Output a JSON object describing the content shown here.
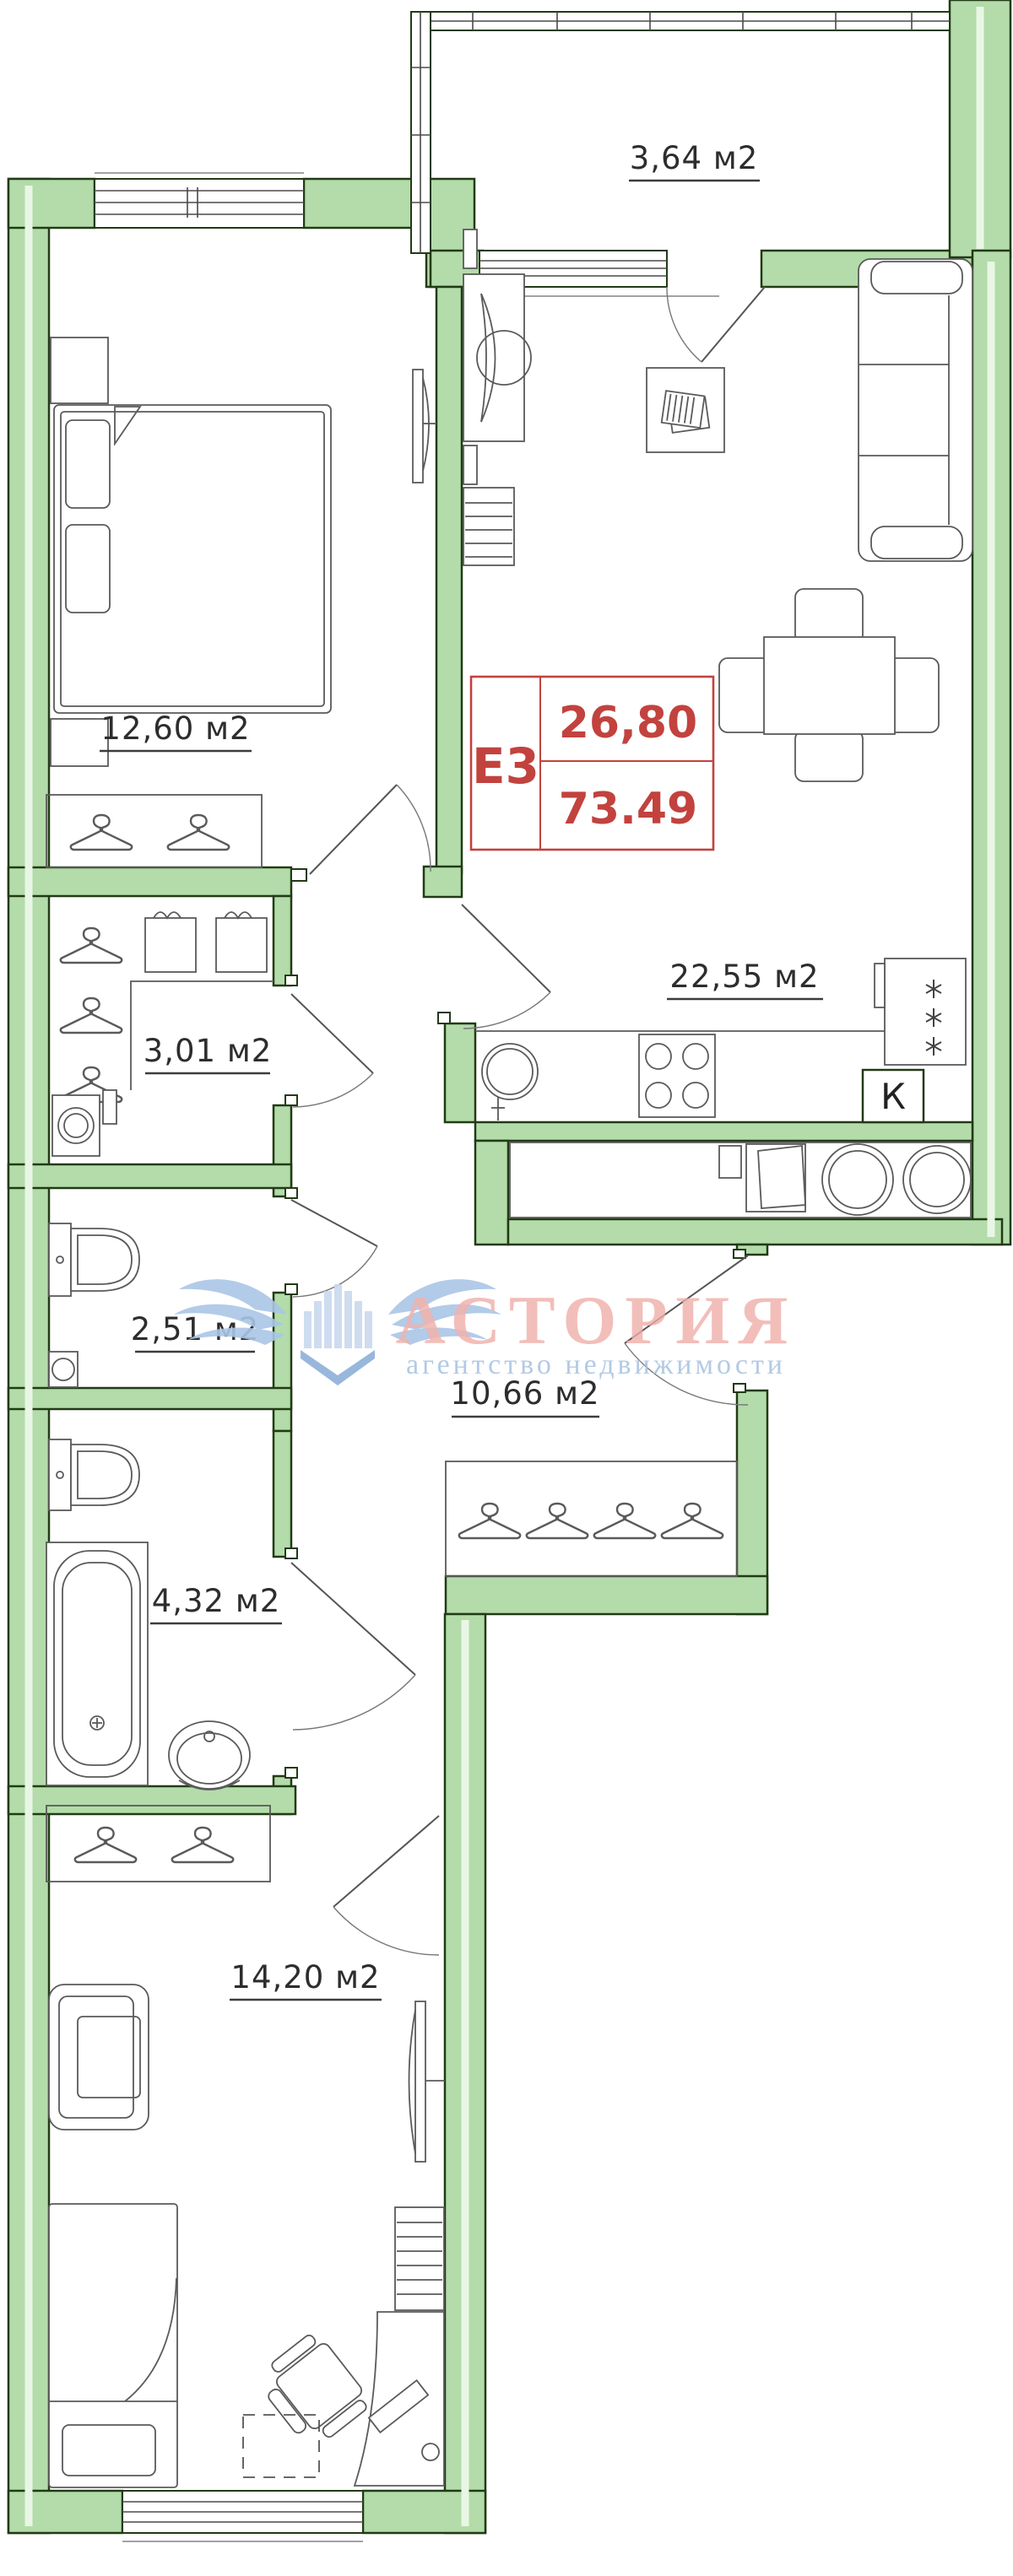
{
  "title": "Floor plan E3 apartment",
  "colors": {
    "wall_green": "#b3dcaa",
    "wall_outline": "#223a15",
    "accent_red": "#c2423e",
    "watermark_pink": "#eeaca7",
    "watermark_blue": "#a7c2e2",
    "furniture_line": "#5a5a5a"
  },
  "rooms": {
    "balcony": {
      "area_label": "3,64 м2"
    },
    "bedroom": {
      "area_label": "12,60 м2"
    },
    "living_kitchen": {
      "area_label": "22,55 м2"
    },
    "closet": {
      "area_label": "3,01 м2"
    },
    "wc": {
      "area_label": "2,51 м2"
    },
    "hallway": {
      "area_label": "10,66 м2"
    },
    "bathroom": {
      "area_label": "4,32 м2"
    },
    "bedroom2": {
      "area_label": "14,20 м2"
    }
  },
  "info_box": {
    "plan_code": "Е3",
    "living_area": "26,80",
    "total_area": "73.49"
  },
  "kitchen": {
    "vent_label": "К"
  },
  "watermark": {
    "brand": "АСТОРИЯ",
    "tagline": "агентство недвижимости"
  }
}
